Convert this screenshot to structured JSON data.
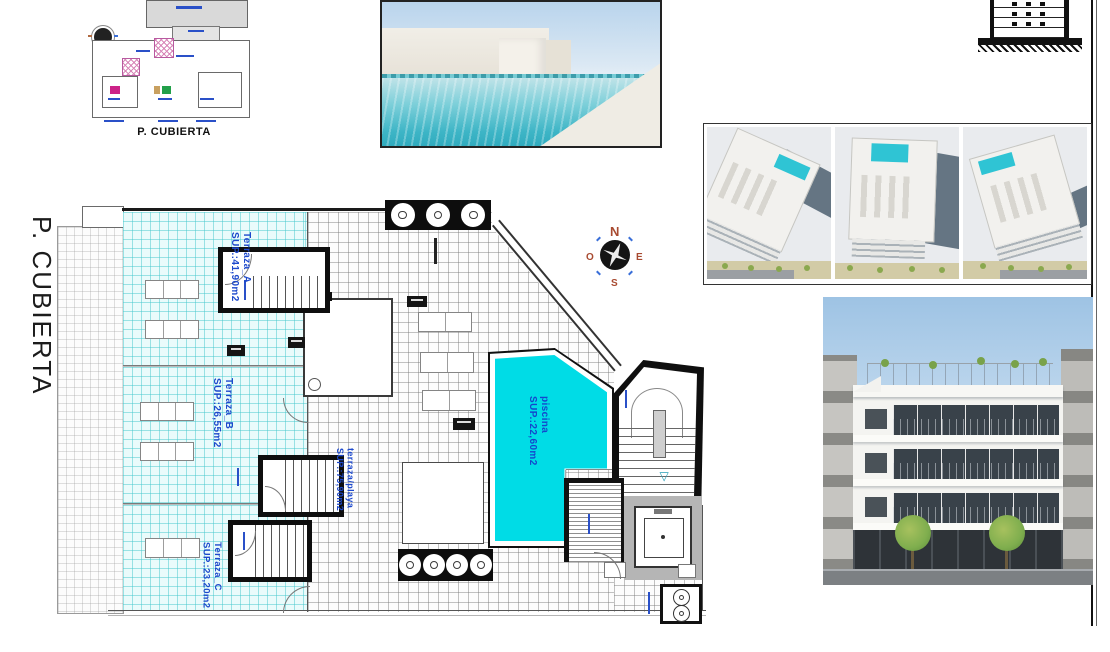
{
  "titles": {
    "side_title": "P. CUBIERTA",
    "key_plan_caption": "P. CUBIERTA"
  },
  "rooms": {
    "terraza_a": {
      "name": "Terraza_A",
      "area": "SUP.:41,90m2"
    },
    "terraza_b": {
      "name": "Terraza_B",
      "area": "SUP.:26,55m2"
    },
    "terraza_c": {
      "name": "Terraza_C",
      "area": "SUP.:23,20m2"
    },
    "playa": {
      "name": "terraza/playa",
      "area": "SUP.:75,90m2"
    },
    "piscina": {
      "name": "piscina",
      "area": "SUP.:22,60m2"
    }
  },
  "compass": {
    "n": "N",
    "e": "E",
    "s": "S",
    "o": "O"
  },
  "colors": {
    "pool": "#00dce6",
    "tile_grid_cyan": "#46c8cd",
    "label_blue": "#1d49cc",
    "compass_red": "#a84a30"
  }
}
